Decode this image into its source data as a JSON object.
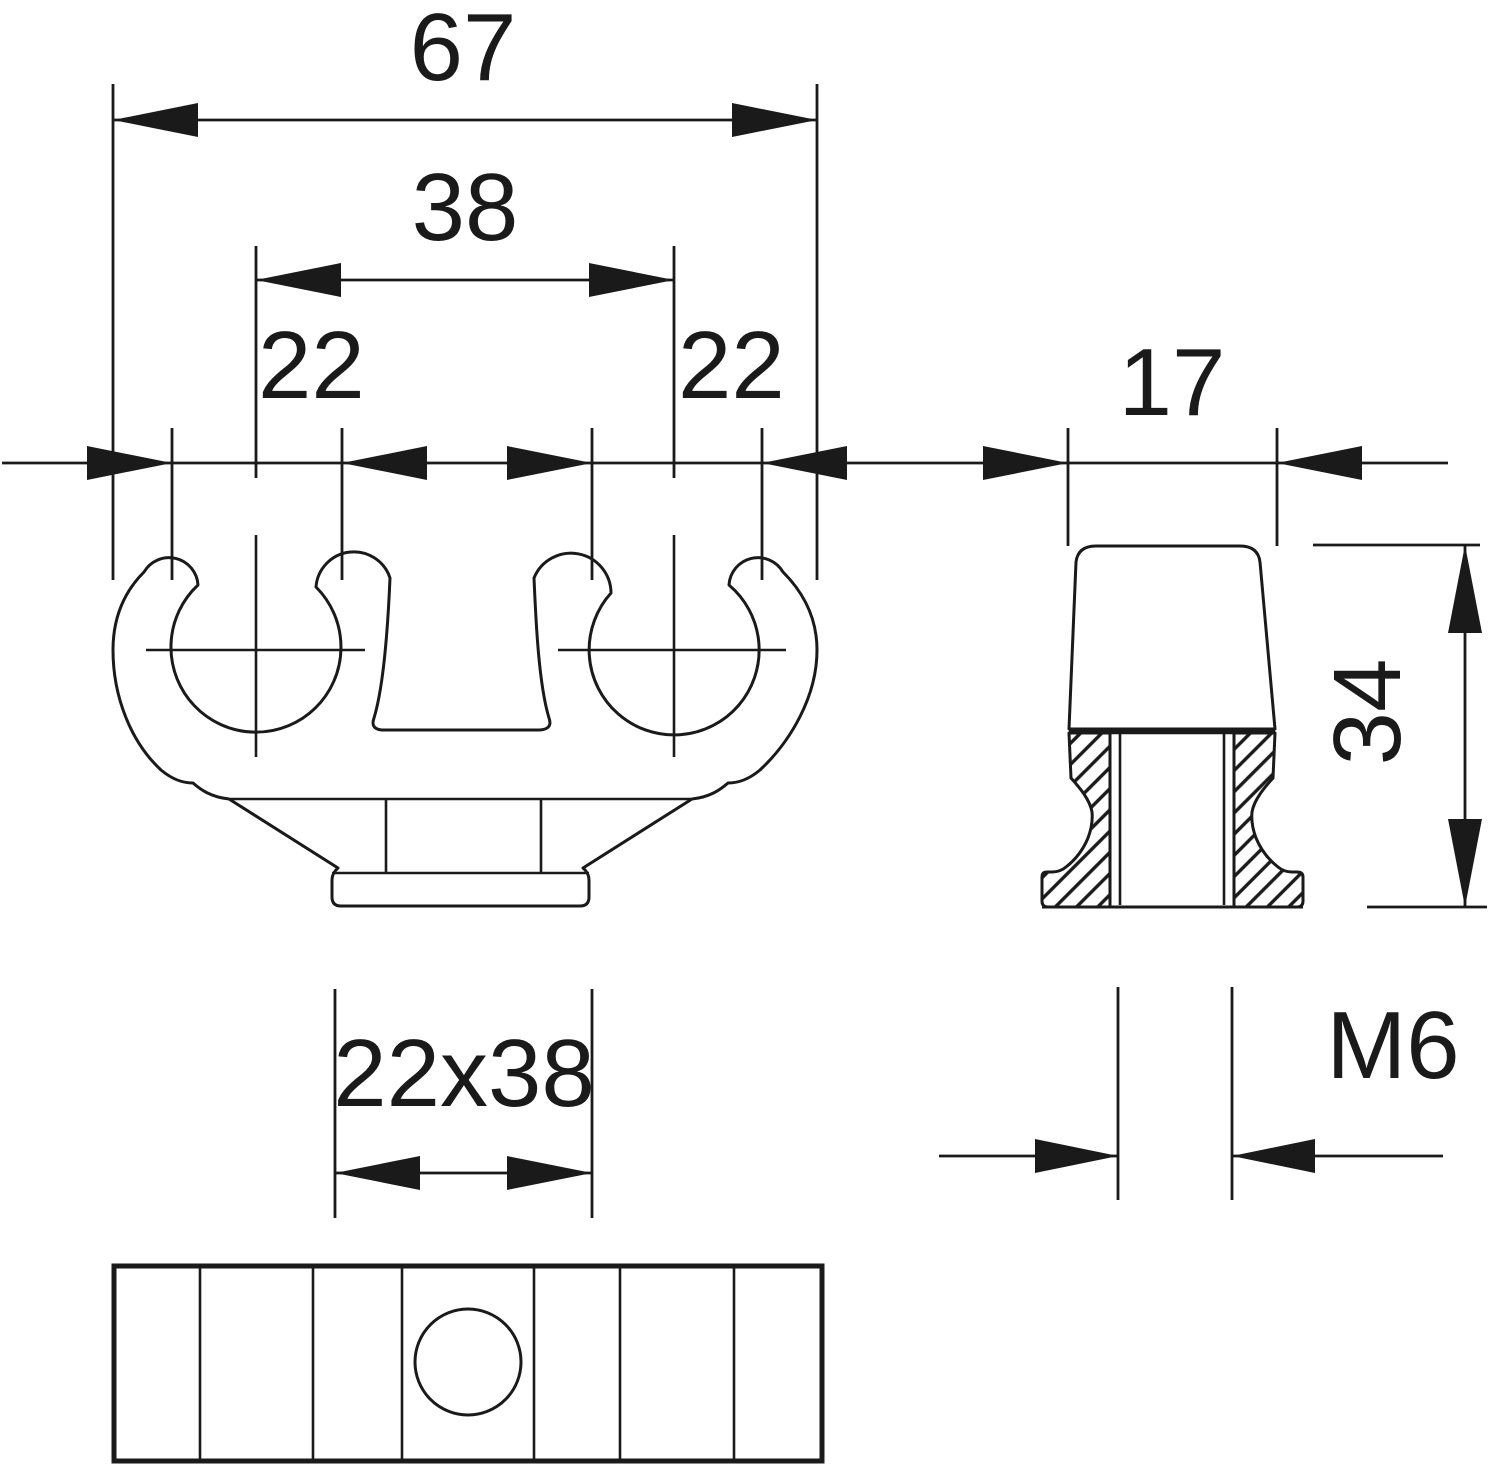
{
  "drawing": {
    "type": "technical-drawing",
    "background_color": "#ffffff",
    "line_color": "#1a1a1a",
    "views": [
      "front-view",
      "side-section-view",
      "bottom-plan-view"
    ]
  },
  "labels": {
    "overall_width": "67",
    "clip_center_spacing": "38",
    "clip_diameter_left": "22",
    "clip_diameter_right": "22",
    "side_width": "17",
    "overall_height": "34",
    "thread_size": "M6",
    "mounting_base": "22x38"
  }
}
